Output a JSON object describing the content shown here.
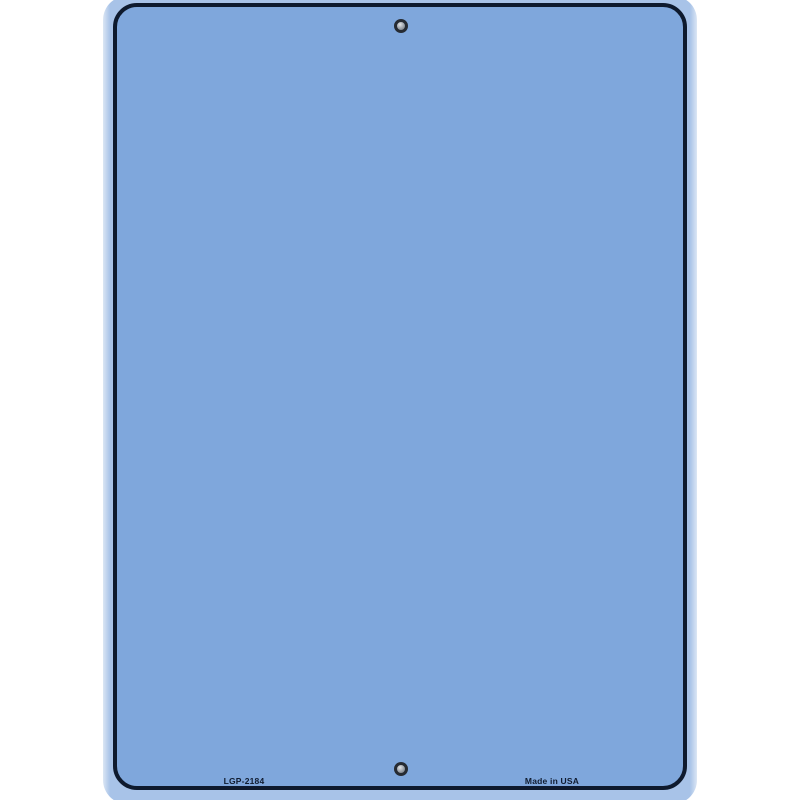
{
  "plate": {
    "sku_label": "LGP-2184",
    "origin_label": "Made in USA",
    "holes": [
      {
        "position": "top-center"
      },
      {
        "position": "bottom-center"
      }
    ]
  },
  "colors": {
    "background": "#ffffff",
    "plate_fill": "#7fa7dc",
    "plate_margin": "#a8c3e8",
    "plate_edge_highlight": "#dbe6f4",
    "border": "#0e1a2e",
    "text": "#101c30",
    "hole_ring": "#262b33",
    "hole_center": "#9aa0a8"
  }
}
